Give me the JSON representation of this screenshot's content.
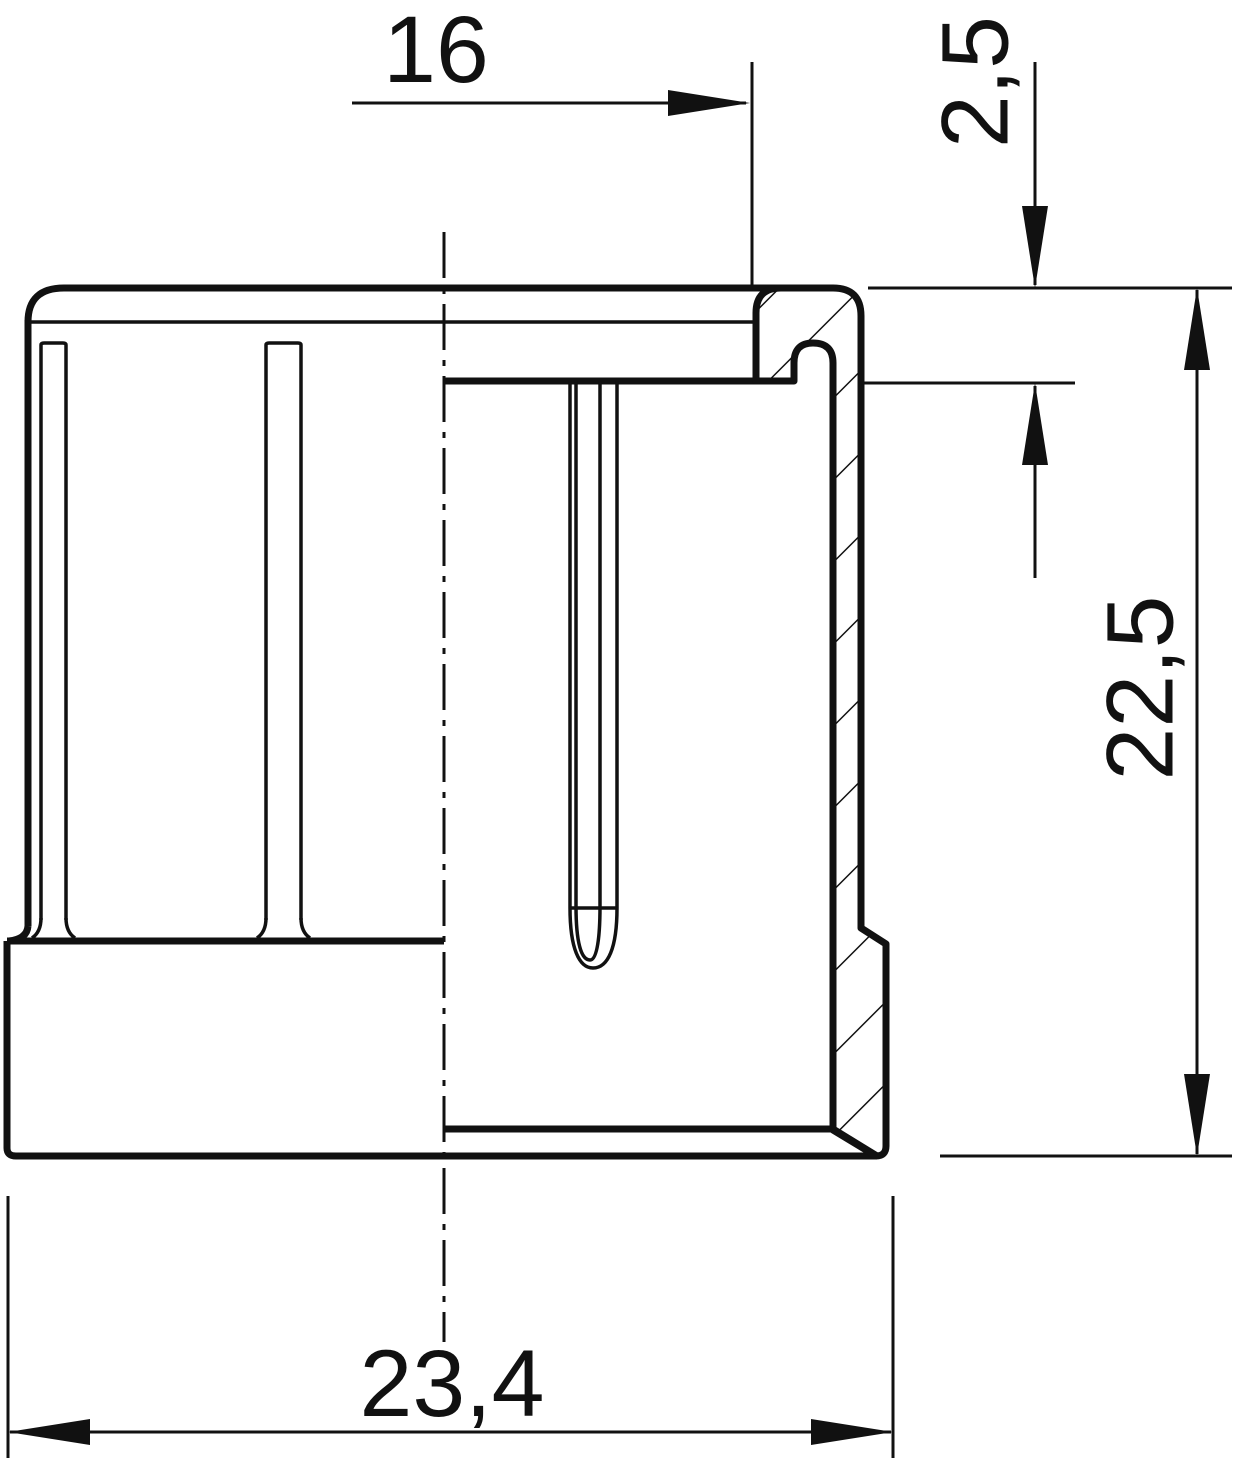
{
  "drawing": {
    "type": "technical-drawing",
    "view": "half-section side view of a round end cap",
    "units": "mm",
    "background_color": "#ffffff",
    "line_color": "#111111",
    "dimensions": {
      "opening_width": {
        "value": "16",
        "orientation": "horizontal",
        "location": "top"
      },
      "rim_depth": {
        "value": "2,5",
        "orientation": "vertical",
        "location": "top-right"
      },
      "overall_height": {
        "value": "22,5",
        "orientation": "vertical",
        "location": "right"
      },
      "base_width": {
        "value": "23,4",
        "orientation": "horizontal",
        "location": "bottom"
      }
    }
  }
}
